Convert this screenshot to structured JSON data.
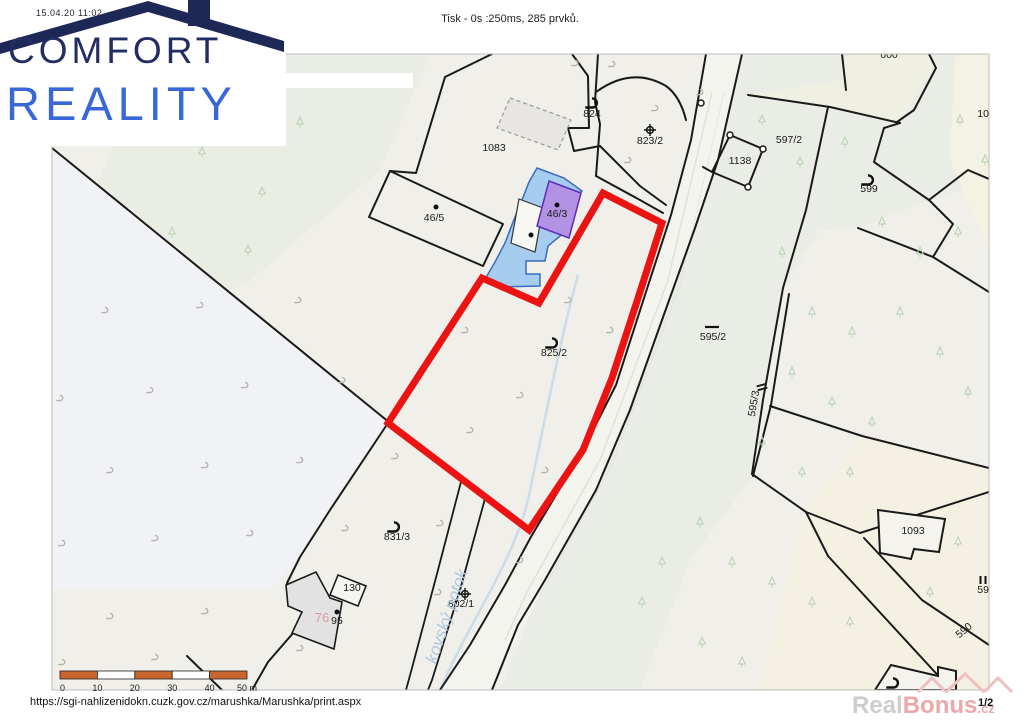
{
  "page": {
    "header": {
      "print_status": "Tisk - 0s :250ms, 285 prvků.",
      "timestamp": "15.04.20 11:02"
    },
    "footer": {
      "url": "https://sgi-nahlizenidokn.cuzk.gov.cz/marushka/Marushka/print.aspx",
      "page_number": "1/2"
    },
    "watermark": {
      "part1": "Real",
      "part2": "Bonus",
      "part3": ".cz"
    },
    "logo": {
      "line1": "COMFORT",
      "line2": "REALITY",
      "color1": "#222e63",
      "color2": "#3a67d8"
    }
  },
  "scale_bar": {
    "ticks": [
      "0",
      "10",
      "20",
      "30",
      "40"
    ],
    "last_tick": "50 m",
    "segment_color": "#c9662e",
    "unit": "m"
  },
  "map": {
    "highlight_color": "#ec1313",
    "water_fill": "#a6cdf0",
    "water_stroke": "#3a6bc0",
    "building_fill": "#b392e3",
    "building_stroke": "#5b2db8",
    "labels": [
      {
        "id": "824",
        "text": "824",
        "x": 592,
        "y": 117
      },
      {
        "id": "823-2",
        "text": "823/2",
        "x": 650,
        "y": 144
      },
      {
        "id": "1138",
        "text": "1138",
        "x": 740,
        "y": 164
      },
      {
        "id": "597-2",
        "text": "597/2",
        "x": 789,
        "y": 143
      },
      {
        "id": "599",
        "text": "599",
        "x": 869,
        "y": 192
      },
      {
        "id": "600",
        "text": "600",
        "x": 889,
        "y": 58
      },
      {
        "id": "109",
        "text": "109",
        "x": 986,
        "y": 117
      },
      {
        "id": "1083",
        "text": "1083",
        "x": 494,
        "y": 151
      },
      {
        "id": "46-5",
        "text": "46/5",
        "x": 434,
        "y": 221
      },
      {
        "id": "46-3",
        "text": "46/3",
        "x": 557,
        "y": 217
      },
      {
        "id": "825-2",
        "text": "825/2",
        "x": 554,
        "y": 356
      },
      {
        "id": "595-2",
        "text": "595/2",
        "x": 713,
        "y": 340
      },
      {
        "id": "595-3",
        "text": "595/3",
        "x": 757,
        "y": 404,
        "rot": -80
      },
      {
        "id": "831-3",
        "text": "831/3",
        "x": 397,
        "y": 540
      },
      {
        "id": "130",
        "text": "130",
        "x": 352,
        "y": 591
      },
      {
        "id": "95",
        "text": "95",
        "x": 337,
        "y": 624
      },
      {
        "id": "76",
        "text": "76",
        "x": 322,
        "y": 622,
        "color": "#dd9a9a",
        "size": 13
      },
      {
        "id": "802-1",
        "text": "802/1",
        "x": 461,
        "y": 607
      },
      {
        "id": "1093",
        "text": "1093",
        "x": 913,
        "y": 534
      },
      {
        "id": "595",
        "text": "595",
        "x": 986,
        "y": 593
      },
      {
        "id": "590",
        "text": "590",
        "x": 966,
        "y": 633,
        "rot": -40
      },
      {
        "id": "stream-name",
        "text": "kovský potok",
        "x": 452,
        "y": 618,
        "rot": -71,
        "color": "#afc9e0",
        "size": 17,
        "italic": true
      }
    ],
    "symbols": [
      {
        "type": "grass",
        "x": 592,
        "y": 103
      },
      {
        "type": "cross",
        "x": 650,
        "y": 130
      },
      {
        "type": "grass",
        "x": 868,
        "y": 180
      },
      {
        "type": "grass",
        "x": 552,
        "y": 343
      },
      {
        "type": "dash",
        "x": 712,
        "y": 327
      },
      {
        "type": "equals",
        "x": 762,
        "y": 387,
        "rot": -15
      },
      {
        "type": "grass",
        "x": 394,
        "y": 527
      },
      {
        "type": "cross",
        "x": 465,
        "y": 594
      },
      {
        "type": "bars",
        "x": 983,
        "y": 580
      },
      {
        "type": "grass",
        "x": 893,
        "y": 683
      },
      {
        "type": "dot",
        "x": 436,
        "y": 207
      },
      {
        "type": "dot",
        "x": 557,
        "y": 205
      },
      {
        "type": "dot",
        "x": 531,
        "y": 235
      },
      {
        "type": "dot",
        "x": 337,
        "y": 612
      }
    ]
  }
}
